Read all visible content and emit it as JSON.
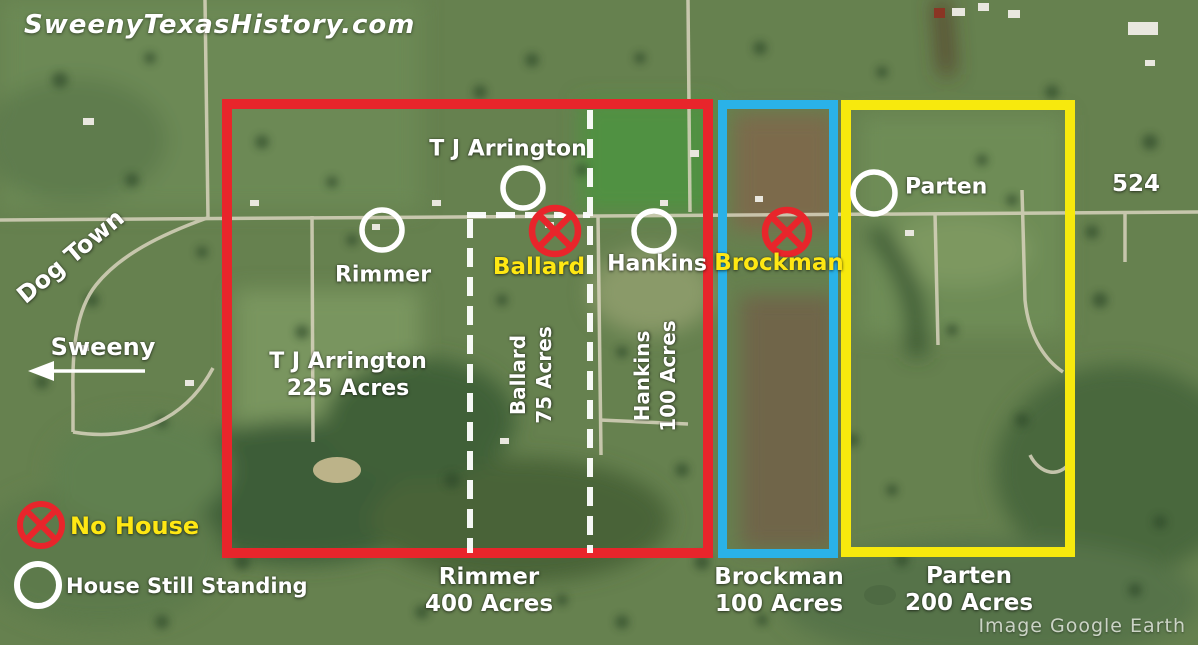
{
  "site": {
    "watermark": "SweenyTexasHistory.com",
    "image_credit": "Image Google Earth"
  },
  "roads": {
    "highway_label": "524",
    "dog_town_label": "Dog Town",
    "sweeny_label": "Sweeny"
  },
  "legend": {
    "no_house_label": "No House",
    "standing_label": "House Still Standing"
  },
  "houses": [
    {
      "name": "T J Arrington",
      "marker": "house-still-standing"
    },
    {
      "name": "Rimmer",
      "marker": "house-still-standing"
    },
    {
      "name": "Ballard",
      "marker": "no-house"
    },
    {
      "name": "Hankins",
      "marker": "house-still-standing"
    },
    {
      "name": "Brockman",
      "marker": "no-house"
    },
    {
      "name": "Parten",
      "marker": "house-still-standing"
    }
  ],
  "parcels": {
    "inner": [
      {
        "owner": "T J Arrington",
        "acreage": "225 Acres"
      },
      {
        "owner": "Ballard",
        "acreage": "75 Acres"
      },
      {
        "owner": "Hankins",
        "acreage": "100 Acres"
      }
    ],
    "outer": [
      {
        "owner": "Rimmer",
        "acreage": "400 Acres",
        "outline_color": "#e8252b"
      },
      {
        "owner": "Brockman",
        "acreage": "100 Acres",
        "outline_color": "#2ab2e8"
      },
      {
        "owner": "Parten",
        "acreage": "200 Acres",
        "outline_color": "#f7e90d"
      }
    ]
  },
  "colors": {
    "marker_white": "#ffffff",
    "marker_no_house_red": "#e8252b",
    "label_yellow": "#ffe713"
  }
}
